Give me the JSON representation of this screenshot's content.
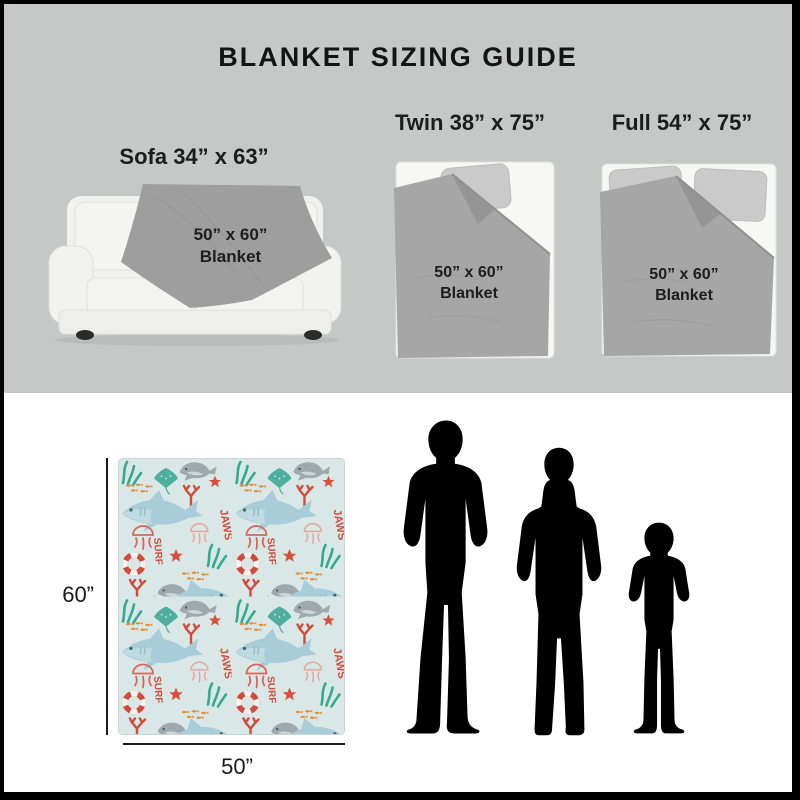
{
  "header": {
    "title": "BLANKET SIZING GUIDE"
  },
  "sizes": {
    "sofa": {
      "label": "Sofa 34” x 63”",
      "blanket_size": "50” x 60”",
      "blanket_word": "Blanket"
    },
    "twin": {
      "label": "Twin 38” x 75”",
      "blanket_size": "50” x 60”",
      "blanket_word": "Blanket"
    },
    "full": {
      "label": "Full 54” x 75”",
      "blanket_size": "50” x 60”",
      "blanket_word": "Blanket"
    }
  },
  "flat_blanket": {
    "height_label": "60”",
    "width_label": "50”",
    "pattern_text_jaws": "JAWS",
    "pattern_text_surf": "SURF"
  },
  "colors": {
    "frame_border": "#000000",
    "top_background": "#c6c7c7",
    "bottom_background": "#ffffff",
    "bed_white": "#f7f7f6",
    "pillow_gray": "#c9cac9",
    "blanket_gray": "#a5a6a5",
    "sofa_blanket_gray": "#9d9e9d",
    "text_dark": "#1c1c1c",
    "silhouette_black": "#000000",
    "pattern_background": "#d9e8e7",
    "pattern_shark_blue": "#a9cdd8",
    "pattern_teal": "#35a98e",
    "pattern_red": "#d14b3b",
    "pattern_orange": "#e2923f",
    "pattern_seal_gray": "#9fa9ad"
  }
}
